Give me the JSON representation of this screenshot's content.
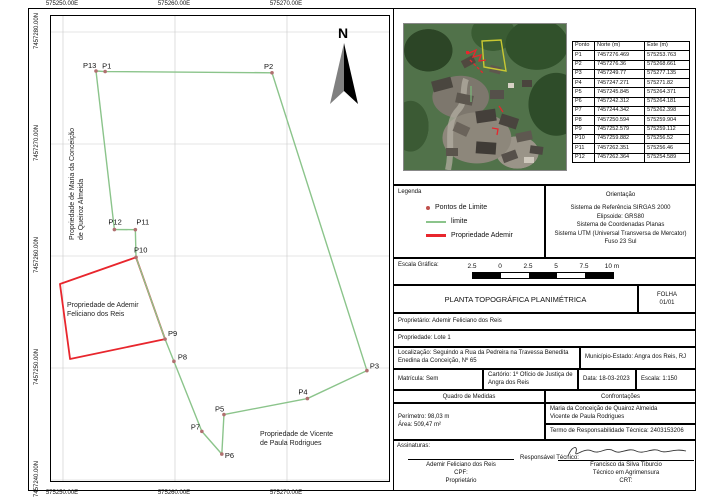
{
  "map": {
    "top_labels": [
      "575250.00E",
      "575260.00E",
      "575270.00E"
    ],
    "bottom_labels": [
      "575250.00E",
      "575260.00E",
      "575270.00E"
    ],
    "left_labels": [
      "7457280.00N",
      "7457270.00N",
      "7457260.00N",
      "7457250.00N",
      "7457240.00N"
    ],
    "eastings": [
      575250,
      575260,
      575270
    ],
    "northings": [
      7457280,
      7457270,
      7457260,
      7457250,
      7457240
    ],
    "north_label": "N",
    "labels": {
      "maria_line1": "Propriedade de Maria da Conceição",
      "maria_line2": "de Queiroz Almeida",
      "ademir_line1": "Propriedade de Ademir",
      "ademir_line2": "Feliciano dos Reis",
      "vicente_line1": "Propriedade de Vicente",
      "vicente_line2": "de Paula Rodrigues"
    },
    "points": [
      {
        "label": "P1",
        "norte": "7457276.469",
        "este": "575253.763",
        "dx": -3,
        "dy": -3,
        "in_table": true
      },
      {
        "label": "P2",
        "norte": "7457276.36",
        "este": "575268.661",
        "dx": -8,
        "dy": -4,
        "in_table": true
      },
      {
        "label": "P3",
        "norte": "7457249.77",
        "este": "575277.135",
        "dx": 3,
        "dy": -2,
        "in_table": true
      },
      {
        "label": "P4",
        "norte": "7457247.271",
        "este": "575271.82",
        "dx": -9,
        "dy": -4,
        "in_table": true
      },
      {
        "label": "P5",
        "norte": "7457245.845",
        "este": "575264.371",
        "dx": -9,
        "dy": -3,
        "in_table": true
      },
      {
        "label": "P6",
        "norte": "7457242.312",
        "este": "575264.181",
        "dx": 3,
        "dy": 4,
        "in_table": true
      },
      {
        "label": "P7",
        "norte": "7457244.342",
        "este": "575262.398",
        "dx": -11,
        "dy": -2,
        "in_table": true
      },
      {
        "label": "P8",
        "norte": "7457250.594",
        "este": "575259.904",
        "dx": 4,
        "dy": -2,
        "in_table": true
      },
      {
        "label": "P9",
        "norte": "7457252.579",
        "este": "575259.112",
        "dx": 3,
        "dy": -3,
        "in_table": true
      },
      {
        "label": "P10",
        "norte": "7457259.882",
        "este": "575256.52",
        "dx": -2,
        "dy": -5,
        "in_table": true
      },
      {
        "label": "P11",
        "norte": "7457262.351",
        "este": "575256.46",
        "dx": 1,
        "dy": -5,
        "in_table": true
      },
      {
        "label": "P12",
        "norte": "7457262.364",
        "este": "575254.589",
        "dx": -6,
        "dy": -5,
        "in_table": true
      },
      {
        "label": "P13",
        "norte": "7457276.518",
        "este": "575252.946",
        "dx": -13,
        "dy": -3,
        "in_table": false
      }
    ],
    "boundary_order": [
      "P1",
      "P2",
      "P3",
      "P4",
      "P5",
      "P6",
      "P7",
      "P8",
      "P9",
      "P10",
      "P11",
      "P12",
      "P13"
    ],
    "red_polygon": [
      [
        575256.52,
        7457259.882
      ],
      [
        575249.73,
        7457257.5
      ],
      [
        575250.63,
        7457250.8
      ],
      [
        575259.112,
        7457252.579
      ]
    ],
    "colors": {
      "boundary": "#8bc48b",
      "property": "#e8262d",
      "point": "#b07070",
      "grid": "#c9c9c9"
    }
  },
  "table": {
    "headers": [
      "Ponto",
      "Norte (m)",
      "Este (m)"
    ]
  },
  "legend": {
    "title": "Legenda",
    "items": [
      {
        "symbol": "point",
        "label": "Pontos de Limite"
      },
      {
        "symbol": "line-green",
        "label": "limite"
      },
      {
        "symbol": "line-red",
        "label": "Propriedade Ademir"
      }
    ]
  },
  "orientation": {
    "title": "Orientação",
    "lines": [
      "Sistema de Referência SIRGAS 2000",
      "Elipsoide: GRS80",
      "Sistema de Coordenadas Planas",
      "Sistema UTM (Universal Transversa de Mercator)",
      "Fuso 23 Sul"
    ]
  },
  "scale_bar": {
    "label": "Escala Gráfica:",
    "ticks": [
      "2.5",
      "0",
      "2.5",
      "5",
      "7.5",
      "10 m"
    ]
  },
  "title_block": {
    "title": "PLANTA TOPOGRÁFICA PLANIMÉTRICA",
    "folha_label": "FOLHA",
    "folha_value": "01/01",
    "proprietario": "Proprietário: Ademir Feliciano dos Reis",
    "propriedade": "Propriedade: Lote 1",
    "localizacao": "Localização: Seguindo a Rua da Pedreira na Travessa Benedita Enedina da Conceição, Nº 65",
    "municipio": "Município-Estado: Angra dos Reis, RJ",
    "matricula": "Matrícula: Sem",
    "cartorio": "Cartório: 1º Ofício de Justiça de Angra dos Reis",
    "data": "Data: 18-03-2023",
    "escala": "Escala: 1:150"
  },
  "quadro": {
    "header": "Quadro de Medidas",
    "perimetro": "Perímetro: 98,03 m",
    "area": "Área: 509,47 m²"
  },
  "confrontacoes": {
    "header": "Confrontações",
    "line1": "Maria da Conceição de Quairoz Almeida",
    "line2": "Vicente de Paula Rodrigues",
    "termo": "Termo de Responsabilidade Técnica: 2403153206"
  },
  "signatures": {
    "title": "Assinaturas:",
    "owner_name": "Ademir Feliciano dos Reis",
    "owner_cpf": "CPF:",
    "owner_role": "Proprietário",
    "resp_label": "Responsável Técnico:",
    "tech_name": "Francisco da Silva Tiburcio",
    "tech_role": "Técnico em Agrimensura",
    "tech_crt": "CRT:"
  }
}
